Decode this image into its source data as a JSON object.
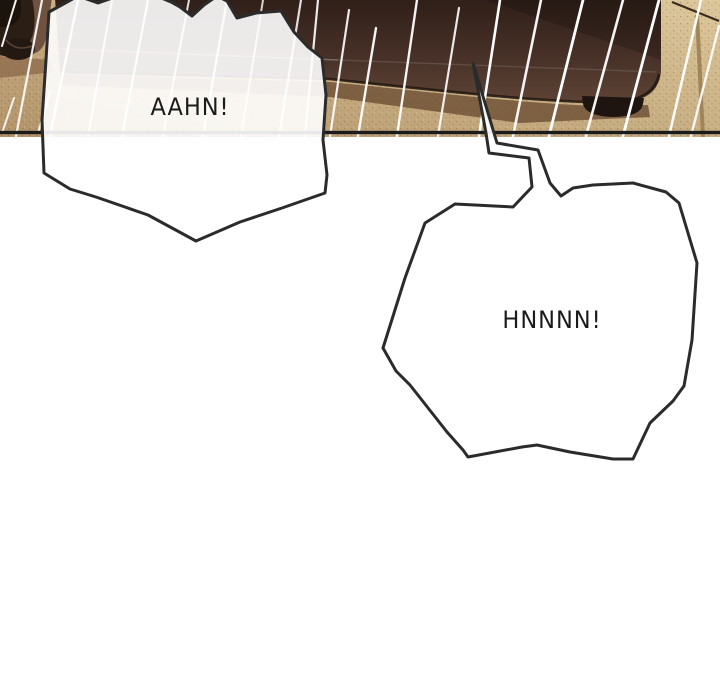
{
  "type": "webtoon-comic-strip-section",
  "panel": {
    "description": "bedroom scene with dark bed and blanket over tan floor, radial white speed lines",
    "speech_bubbles": [
      {
        "id": "aahn",
        "text": "AAHN!"
      },
      {
        "id": "hnnnn",
        "text": "HNNNN!"
      }
    ]
  },
  "colors": {
    "page_bg": "#ffffff",
    "text_ink": "#1b1b1b",
    "bubble_fill": "#ffffff",
    "bubble_stroke": "#2b2b2b",
    "panel_border": "#1b1b1b",
    "floor_dark": "#b3946a",
    "floor_light": "#dcc79b",
    "bed_top": "#2f1f18",
    "bed_mid": "#463027",
    "bed_bottom": "#5d4335",
    "bed_shadow": "#6b4e33",
    "fabric_dark": "#2b1e15",
    "fabric_mid": "#6f5340",
    "speed_line": "#ffffff"
  }
}
